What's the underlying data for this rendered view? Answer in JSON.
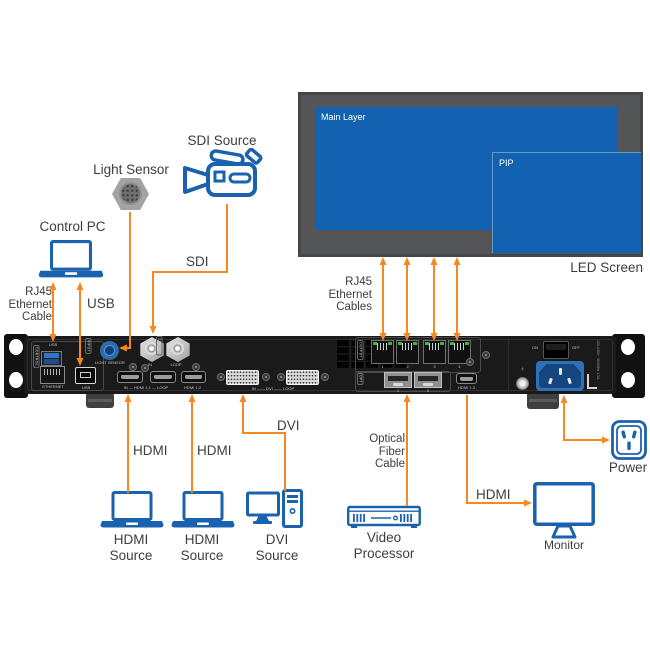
{
  "labels": {
    "control_pc": "Control PC",
    "light_sensor": "Light Sensor",
    "sdi_source": "SDI Source",
    "rj45_cable": [
      "RJ45",
      "Ethernet",
      "Cable"
    ],
    "usb": "USB",
    "sdi": "SDI",
    "rj45_cables": [
      "RJ45",
      "Ethernet",
      "Cables"
    ],
    "led_screen": "LED Screen",
    "main_layer": "Main Layer",
    "pip": "PIP",
    "hdmi_1": "HDMI",
    "hdmi_2": "HDMI",
    "dvi": "DVI",
    "hdmi_source_1": [
      "HDMI",
      "Source"
    ],
    "hdmi_source_2": [
      "HDMI",
      "Source"
    ],
    "dvi_source": [
      "DVI",
      "Source"
    ],
    "optical": [
      "Optical",
      "Fiber",
      "Cable"
    ],
    "video_processor": [
      "Video",
      "Processor"
    ],
    "hdmi_monitor": "HDMI",
    "monitor": "Monitor",
    "power": "Power"
  },
  "device": {
    "control": "CONTROL",
    "usb_a": "USB",
    "ethernet": "ETHERNET",
    "usb_b": "USB",
    "input": "INPUT",
    "light_sensor": "LIGHT SENSOR",
    "sdi_badge": "12G-SDI",
    "sdi_in": "IN",
    "sdi_loop": "LOOP",
    "hdmi_1_1": "IN — HDMI 1.1 — LOOP",
    "hdmi_1_2": "HDMI 1.2",
    "dvi_group": "IN —— DVI —— LOOP",
    "output": "OUTPUT",
    "rj45_numbers": [
      "1",
      "2",
      "3",
      "4"
    ],
    "opt": "OPT",
    "opt_numbers": [
      "1",
      "2"
    ],
    "hdmi_1_3": "HDMI 1.3",
    "on": "ON",
    "off": "OFF",
    "power_rating": "100-240V~ 50/60Hz 1.5A"
  },
  "colors": {
    "cable_orange": "#F5881F",
    "icon_blue": "#1B62AE",
    "layer_blue": "#1362B2",
    "screen_gray": "#545557"
  }
}
